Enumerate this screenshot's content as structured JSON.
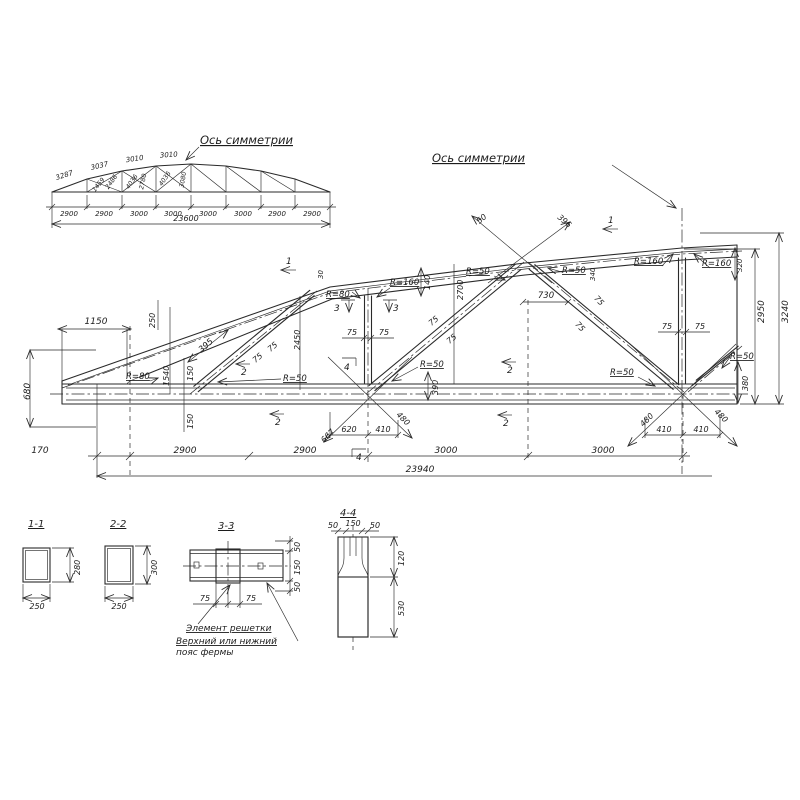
{
  "axis_label": "Ось симметрии",
  "notes": {
    "lattice": "Элемент решетки",
    "chord_line1": "Верхний или нижний",
    "chord_line2": "пояс фермы"
  },
  "small_truss": {
    "top_chord": [
      "3287",
      "3037",
      "3010",
      "3010"
    ],
    "web": [
      "1459",
      "2486",
      "4036",
      "2780",
      "4036",
      "3080"
    ],
    "panels": [
      "2900",
      "2900",
      "3000",
      "3000",
      "3000",
      "3000",
      "2900",
      "2900"
    ],
    "total": "23600"
  },
  "main_truss": {
    "total": "23940",
    "bottom": [
      "170",
      "2900",
      "2900",
      "3000",
      "3000"
    ],
    "dims": {
      "r50": "R=50",
      "r80": "R=80",
      "r160": "R=160",
      "n30": "30",
      "n50": "50",
      "n75": "75",
      "n140": "140",
      "n150": "150",
      "n250": "250",
      "n320": "320",
      "n340": "340",
      "n380": "380",
      "n390": "390",
      "n395": "395",
      "n396": "396",
      "n410": "410",
      "n480": "480",
      "n620": "620",
      "n667": "667",
      "n680": "680",
      "n730": "730",
      "n1150": "1150",
      "n1540": "1540",
      "n2450": "2450",
      "n2700": "2700",
      "n2950": "2950",
      "n3240": "3240"
    },
    "markers": {
      "m1": "1",
      "m2": "2",
      "m3": "3",
      "m4": "4"
    }
  },
  "sections": {
    "s11": {
      "title": "1-1",
      "w": "250",
      "h": "280"
    },
    "s22": {
      "title": "2-2",
      "w": "250",
      "h": "300"
    },
    "s33": {
      "title": "3-3",
      "v50": "50",
      "v150": "150",
      "h75": "75"
    },
    "s44": {
      "title": "4-4",
      "t50": "50",
      "t150": "150",
      "v120": "120",
      "v530": "530"
    }
  }
}
